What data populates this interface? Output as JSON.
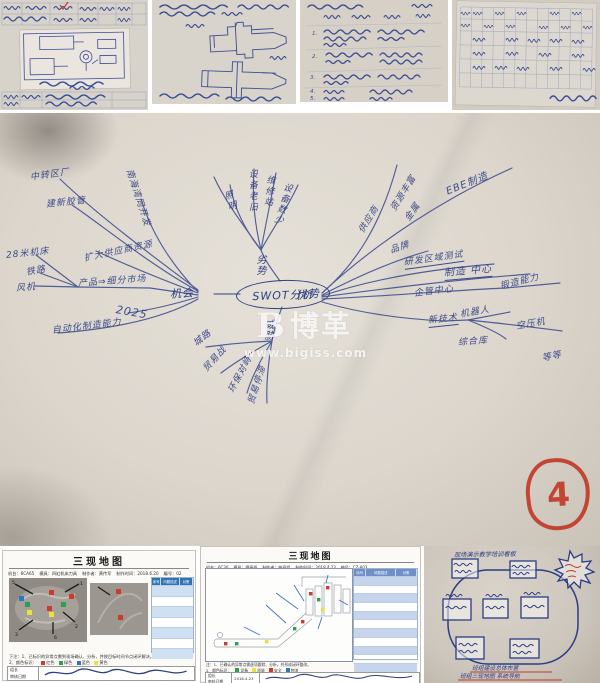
{
  "collage": {
    "watermark": {
      "logo_letter": "B",
      "brand": "博革",
      "url": "www.bigiss.com"
    },
    "stamp_number": "4"
  },
  "mindmap": {
    "center": "SWOT分析",
    "node_left": "机会",
    "node_right": "优势",
    "node_top": "劣势",
    "node_bottom": "威胁",
    "left": [
      "中转区厂",
      "建新胶管",
      "南海湾同开发",
      "扩大供应商资源",
      "28米机床",
      "铁路",
      "风机",
      "产品⇒细分市场",
      "2025",
      "自动化制造能力"
    ],
    "top": [
      "照明",
      "设备老旧",
      "维修站",
      "设备数少"
    ],
    "right": [
      "供应商",
      "资源丰富",
      "金属",
      "EBE制造",
      "品牌",
      "研发区域测试",
      "制造 中心",
      "企管中心",
      "锻造能力",
      "新技术",
      "机器人",
      "空压机",
      "综合库",
      "等等"
    ],
    "bottom": [
      "城路",
      "贸易战",
      "环保对峙",
      "贸易停滞"
    ]
  },
  "top_photos": {
    "photo3_numbers": [
      "1.",
      "2.",
      "3.",
      "4.",
      "5."
    ]
  },
  "doc1": {
    "title": "三现地图",
    "fields": [
      "机台：6CA65",
      "模具：四缸机床刀具",
      "制作者：黄传军",
      "制作时间：2018.6.20",
      "编号：02"
    ],
    "table_headers": [
      "序号",
      "问题描述",
      "对策"
    ],
    "note1": "下注：1、已标识的异常点需到现场确认、分析，并按目标时间节点闭环解决。",
    "note2": "2、颜色标识：",
    "legend": [
      {
        "label": "红色",
        "color": "#cf3a2b"
      },
      {
        "label": "绿色",
        "color": "#2e9e4f"
      },
      {
        "label": "蓝色",
        "color": "#2d76c4"
      },
      {
        "label": "黄色",
        "color": "#e9e23a"
      }
    ],
    "marker_numbers": [
      "1",
      "2",
      "3",
      "5",
      "6"
    ],
    "sign_labels": [
      "组长",
      "审核日期"
    ]
  },
  "doc2": {
    "title": "三现地图",
    "fields": [
      "机台：6C30",
      "模具：焊接线",
      "制作者：曲班组",
      "制作时间：2018.4.23",
      "编号：CZ-A03"
    ],
    "table_headers": [
      "序号",
      "问题描述",
      "对策"
    ],
    "note1": "注：1、已确认的异常点需逐项跟踪、分析，并形成闭环整改。",
    "note2": "2、颜色标识：",
    "legend": [
      {
        "label": "设备",
        "color": "#2e9e4f"
      },
      {
        "label": "质量",
        "color": "#e9e23a"
      },
      {
        "label": "安全",
        "color": "#cf3a2b"
      },
      {
        "label": "物流",
        "color": "#2d76c4"
      }
    ],
    "sign_labels": [
      "组长",
      "审核日期"
    ],
    "sign_date": "2018.4.23"
  },
  "doc3": {
    "title": "现场演示教学培训看板",
    "caption1": "班组建设总体布置",
    "caption2": "班组三现地图 系统导航"
  }
}
